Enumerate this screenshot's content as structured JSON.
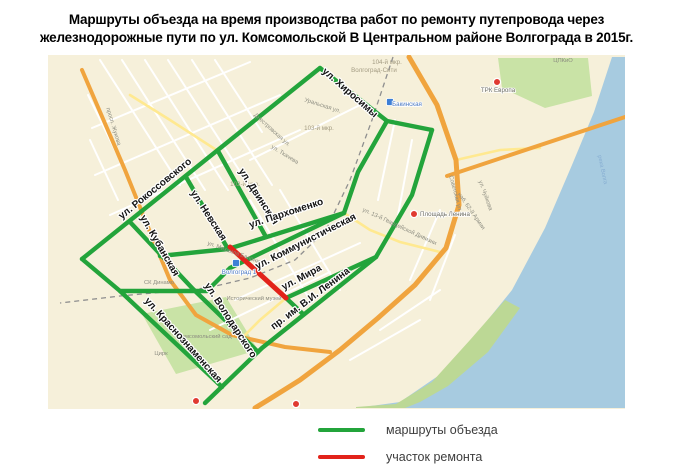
{
  "title": {
    "line1": "Маршруты объезда на время производства работ по ремонту путепровода через",
    "line2": "железнодорожные пути по ул. Комсомольской В Центральном районе Волгограда в 2015г."
  },
  "legend": {
    "items": [
      {
        "label": "маршруты объезда",
        "color": "#23a43b"
      },
      {
        "label": "участок ремонта",
        "color": "#e2231a"
      }
    ]
  },
  "map": {
    "colors": {
      "bg": "#f6f0da",
      "water": "#a7cbe0",
      "park": "#c9e3a6",
      "shore_park": "#bcd895",
      "white_road": "#ffffff",
      "yellow_road": "#ffe990",
      "orange_road": "#f0a43e",
      "railway": "#8f8f8f",
      "detour": "#23a43b",
      "repair": "#e2231a",
      "minor_label": "#8c8c80",
      "district_label": "#a39b82",
      "station_label": "#4a78c2",
      "water_label": "#87aed2",
      "main_label": "#141414",
      "red_pin": "#e03a30",
      "blue_marker": "#3d7fd6"
    },
    "water_polygon": [
      [
        612,
        57
      ],
      [
        625,
        57
      ],
      [
        625,
        408
      ],
      [
        356,
        408
      ],
      [
        400,
        402
      ],
      [
        438,
        376
      ],
      [
        478,
        332
      ],
      [
        512,
        290
      ],
      [
        545,
        228
      ],
      [
        572,
        165
      ],
      [
        594,
        112
      ]
    ],
    "parks": [
      {
        "name": "park-cpkio",
        "points": [
          [
            498,
            58
          ],
          [
            588,
            58
          ],
          [
            592,
            96
          ],
          [
            545,
            108
          ],
          [
            502,
            88
          ]
        ]
      },
      {
        "name": "park-komsomolsky-sad",
        "points": [
          [
            142,
            314
          ],
          [
            226,
            297
          ],
          [
            258,
            350
          ],
          [
            176,
            374
          ]
        ]
      },
      {
        "name": "park-embankment",
        "points": [
          [
            356,
            407
          ],
          [
            396,
            404
          ],
          [
            432,
            382
          ],
          [
            470,
            340
          ],
          [
            505,
            300
          ],
          [
            520,
            308
          ],
          [
            488,
            352
          ],
          [
            448,
            386
          ],
          [
            420,
            402
          ],
          [
            405,
            408
          ],
          [
            356,
            408
          ]
        ]
      }
    ],
    "white_roads": [
      [
        [
          100,
          60
        ],
        [
          180,
          185
        ]
      ],
      [
        [
          122,
          60
        ],
        [
          205,
          190
        ]
      ],
      [
        [
          145,
          60
        ],
        [
          228,
          190
        ]
      ],
      [
        [
          168,
          60
        ],
        [
          250,
          187
        ]
      ],
      [
        [
          192,
          60
        ],
        [
          272,
          185
        ]
      ],
      [
        [
          215,
          60
        ],
        [
          262,
          132
        ]
      ],
      [
        [
          92,
          128
        ],
        [
          250,
          62
        ]
      ],
      [
        [
          95,
          175
        ],
        [
          280,
          95
        ]
      ],
      [
        [
          110,
          215
        ],
        [
          300,
          130
        ]
      ],
      [
        [
          250,
          160
        ],
        [
          360,
          105
        ]
      ],
      [
        [
          235,
          300
        ],
        [
          360,
          243
        ]
      ],
      [
        [
          210,
          330
        ],
        [
          330,
          272
        ]
      ],
      [
        [
          250,
          200
        ],
        [
          310,
          300
        ]
      ],
      [
        [
          280,
          190
        ],
        [
          340,
          290
        ]
      ],
      [
        [
          395,
          120
        ],
        [
          378,
          200
        ]
      ],
      [
        [
          412,
          140
        ],
        [
          398,
          215
        ]
      ],
      [
        [
          440,
          210
        ],
        [
          410,
          280
        ]
      ],
      [
        [
          455,
          235
        ],
        [
          430,
          300
        ]
      ],
      [
        [
          380,
          330
        ],
        [
          440,
          290
        ]
      ],
      [
        [
          350,
          360
        ],
        [
          420,
          320
        ]
      ],
      [
        [
          88,
          95
        ],
        [
          120,
          160
        ]
      ],
      [
        [
          90,
          140
        ],
        [
          118,
          200
        ]
      ]
    ],
    "yellow_roads": [
      [
        [
          218,
          151
        ],
        [
          170,
          120
        ],
        [
          130,
          95
        ]
      ],
      [
        [
          344,
          213
        ],
        [
          370,
          230
        ],
        [
          400,
          242
        ],
        [
          440,
          252
        ]
      ],
      [
        [
          286,
          298
        ],
        [
          260,
          320
        ],
        [
          240,
          340
        ]
      ],
      [
        [
          456,
          160
        ],
        [
          500,
          150
        ],
        [
          540,
          148
        ]
      ]
    ],
    "orange_roads": [
      {
        "name": "road-zhukova",
        "width": 4,
        "points": [
          [
            82,
            70
          ],
          [
            125,
            170
          ],
          [
            150,
            232
          ],
          [
            170,
            280
          ],
          [
            196,
            315
          ],
          [
            232,
            335
          ],
          [
            285,
            347
          ],
          [
            330,
            352
          ]
        ]
      },
      {
        "name": "road-prospekt-lenina",
        "width": 5,
        "points": [
          [
            409,
            57
          ],
          [
            437,
            105
          ],
          [
            456,
            160
          ],
          [
            459,
            205
          ],
          [
            446,
            248
          ],
          [
            415,
            285
          ],
          [
            378,
            318
          ],
          [
            340,
            350
          ],
          [
            300,
            380
          ],
          [
            268,
            400
          ],
          [
            255,
            408
          ]
        ]
      },
      {
        "name": "road-bridge",
        "width": 4,
        "points": [
          [
            447,
            176
          ],
          [
            625,
            117
          ]
        ]
      }
    ],
    "railway": [
      [
        393,
        57
      ],
      [
        372,
        120
      ],
      [
        350,
        180
      ],
      [
        326,
        230
      ],
      [
        295,
        260
      ],
      [
        250,
        278
      ],
      [
        207,
        288
      ],
      [
        120,
        296
      ],
      [
        60,
        303
      ]
    ],
    "detour_routes": [
      {
        "name": "ул. Рокоссовского",
        "points": [
          [
            320,
            68
          ],
          [
            82,
            259
          ]
        ]
      },
      {
        "name": "соединение вдоль ж/д",
        "points": [
          [
            82,
            259
          ],
          [
            120,
            291
          ],
          [
            207,
            291
          ]
        ]
      },
      {
        "name": "ул. Хиросимы",
        "points": [
          [
            320,
            68
          ],
          [
            387,
            121
          ],
          [
            432,
            130
          ]
        ]
      },
      {
        "name": "восточный съезд",
        "points": [
          [
            432,
            130
          ],
          [
            412,
            195
          ],
          [
            376,
            257
          ]
        ]
      },
      {
        "name": "съезд к ул. Коммунистической",
        "points": [
          [
            387,
            121
          ],
          [
            358,
            172
          ],
          [
            344,
            213
          ]
        ]
      },
      {
        "name": "ул. Коммунистическая",
        "points": [
          [
            344,
            213
          ],
          [
            230,
            268
          ],
          [
            208,
            290
          ]
        ]
      },
      {
        "name": "ул. Пархоменко",
        "points": [
          [
            160,
            256
          ],
          [
            228,
            249
          ],
          [
            344,
            213
          ]
        ]
      },
      {
        "name": "ул. Кубанская — ул. Володарского",
        "points": [
          [
            130,
            222
          ],
          [
            193,
            289
          ],
          [
            258,
            352
          ]
        ]
      },
      {
        "name": "ул. Невская",
        "points": [
          [
            186,
            177
          ],
          [
            228,
            249
          ]
        ]
      },
      {
        "name": "ул. Двинская",
        "points": [
          [
            218,
            151
          ],
          [
            266,
            237
          ]
        ]
      },
      {
        "name": "ул. Мира",
        "points": [
          [
            286,
            298
          ],
          [
            376,
            257
          ]
        ]
      },
      {
        "name": "пр. им. В.И. Ленина",
        "points": [
          [
            205,
            403
          ],
          [
            262,
            348
          ],
          [
            376,
            257
          ]
        ]
      },
      {
        "name": "ул. Краснознаменская",
        "points": [
          [
            120,
            291
          ],
          [
            222,
            387
          ]
        ]
      },
      {
        "name": "проезд у музея",
        "points": [
          [
            286,
            298
          ],
          [
            303,
            314
          ]
        ]
      }
    ],
    "repair_segment": {
      "name": "участок ремонта (ул. Комсомольская)",
      "points": [
        [
          230,
          247
        ],
        [
          286,
          298
        ]
      ]
    },
    "street_labels": [
      {
        "text": "ул. Рокоссовского",
        "x": 157,
        "y": 191,
        "rot": -39
      },
      {
        "text": "ул. Хиросимы",
        "x": 348,
        "y": 95,
        "rot": 41
      },
      {
        "text": "ул. Двинская",
        "x": 256,
        "y": 198,
        "rot": 57
      },
      {
        "text": "ул. Невская",
        "x": 206,
        "y": 217,
        "rot": 57
      },
      {
        "text": "ул. Кубанская",
        "x": 157,
        "y": 247,
        "rot": 60
      },
      {
        "text": "ул. Пархоменко",
        "x": 287,
        "y": 216,
        "rot": -18
      },
      {
        "text": "ул. Коммунистическая",
        "x": 307,
        "y": 244,
        "rot": -27
      },
      {
        "text": "ул. Мира",
        "x": 303,
        "y": 280,
        "rot": -28
      },
      {
        "text": "пр. им. В.И. Ленина",
        "x": 312,
        "y": 301,
        "rot": -37
      },
      {
        "text": "ул. Володарского",
        "x": 228,
        "y": 322,
        "rot": 57
      },
      {
        "text": "ул. Краснознаменская",
        "x": 181,
        "y": 342,
        "rot": 48
      }
    ],
    "minor_labels": [
      {
        "text": "104-й мкр.",
        "x": 387,
        "y": 64,
        "rot": 0,
        "kind": "district"
      },
      {
        "text": "Волгоград-Сити",
        "x": 374,
        "y": 72,
        "rot": 0,
        "kind": "district"
      },
      {
        "text": "103-й мкр.",
        "x": 319,
        "y": 130,
        "rot": 0,
        "kind": "district"
      },
      {
        "text": "102-й мкр.",
        "x": 245,
        "y": 186,
        "rot": 0,
        "kind": "district"
      },
      {
        "text": "Уральская ул.",
        "x": 322,
        "y": 107,
        "rot": 18,
        "kind": "street"
      },
      {
        "text": "Днестровская ул.",
        "x": 271,
        "y": 131,
        "rot": 42,
        "kind": "street"
      },
      {
        "text": "ул. Ткачева",
        "x": 284,
        "y": 156,
        "rot": 32,
        "kind": "street"
      },
      {
        "text": "просп. Жукова",
        "x": 112,
        "y": 127,
        "rot": 73,
        "kind": "street"
      },
      {
        "text": "СК Динамо",
        "x": 159,
        "y": 284,
        "rot": 0,
        "kind": "poi"
      },
      {
        "text": "Комсомольский сад",
        "x": 205,
        "y": 338,
        "rot": 0,
        "kind": "poi"
      },
      {
        "text": "Цирк",
        "x": 161,
        "y": 355,
        "rot": 0,
        "kind": "poi"
      },
      {
        "text": "Исторический музей",
        "x": 254,
        "y": 300,
        "rot": 0,
        "kind": "poi"
      },
      {
        "text": "ул. Михаила Балонина",
        "x": 236,
        "y": 255,
        "rot": 20,
        "kind": "street"
      },
      {
        "text": "Советская ул.",
        "x": 454,
        "y": 194,
        "rot": 75,
        "kind": "street"
      },
      {
        "text": "ул. Чуйкова",
        "x": 484,
        "y": 196,
        "rot": 70,
        "kind": "street"
      },
      {
        "text": "наб. 62-й Армии",
        "x": 470,
        "y": 212,
        "rot": 55,
        "kind": "street"
      },
      {
        "text": "ул. 13-й Гвардейской Дивизии",
        "x": 399,
        "y": 228,
        "rot": 25,
        "kind": "street"
      },
      {
        "text": "ЦПКиО",
        "x": 563,
        "y": 62,
        "rot": 0,
        "kind": "poi"
      },
      {
        "text": "река Волга",
        "x": 601,
        "y": 170,
        "rot": 78,
        "kind": "water"
      }
    ],
    "poi_markers": [
      {
        "name": "marker-trk-evropa",
        "type": "red-pin",
        "x": 497,
        "y": 82,
        "label": "ТРК Европа",
        "lx": 498,
        "ly": 92
      },
      {
        "name": "marker-ploshchad-lenina",
        "type": "red-pin",
        "x": 414,
        "y": 214,
        "label": "Площадь Ленина",
        "lx": 440,
        "ly": 216
      },
      {
        "name": "marker-south-1",
        "type": "red-pin",
        "x": 196,
        "y": 401,
        "label": "",
        "lx": 0,
        "ly": 0
      },
      {
        "name": "marker-south-2",
        "type": "red-pin",
        "x": 296,
        "y": 404,
        "label": "",
        "lx": 0,
        "ly": 0
      },
      {
        "name": "marker-bakinskaya",
        "type": "blue-square",
        "x": 390,
        "y": 102,
        "label": "Бакинская",
        "lx": 407,
        "ly": 106
      },
      {
        "name": "marker-volgograd-1",
        "type": "blue-square",
        "x": 236,
        "y": 263,
        "label": "Волгоград 1",
        "lx": 239,
        "ly": 274
      }
    ]
  }
}
